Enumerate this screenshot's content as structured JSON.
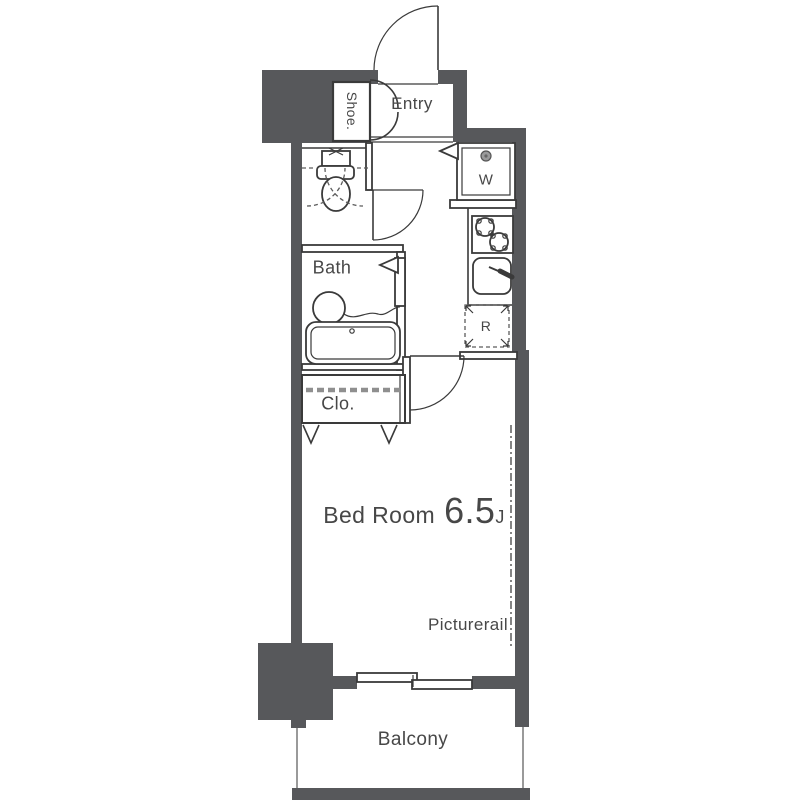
{
  "title": "Studio apartment floor plan",
  "colors": {
    "wall": "#57585b",
    "line": "#3a3a3a",
    "text": "#474747",
    "muted": "#9a9a9a",
    "closet_dash": "#8f8f8f"
  },
  "rooms": {
    "shoe": {
      "label": "Shoe."
    },
    "entry": {
      "label": "Entry"
    },
    "washer": {
      "label": "W"
    },
    "bath": {
      "label": "Bath"
    },
    "closet": {
      "label": "Clo."
    },
    "fridge": {
      "label": "R"
    },
    "bedroom": {
      "label": "Bed Room",
      "size": "6.5",
      "unit": "J"
    },
    "picture_rail": {
      "label": "Picturerail"
    },
    "balcony": {
      "label": "Balcony"
    }
  },
  "icons": [
    "front-door-arc",
    "shoe-closet-doors",
    "toilet-icon",
    "toilet-door-swing",
    "washing-machine-icon",
    "stove-icon",
    "kitchen-sink-icon",
    "fridge-space-box",
    "bath-door",
    "wash-basin-icon",
    "bathtub-icon",
    "closet-hanger-icon",
    "bedroom-door-arc",
    "sliding-window-icon",
    "picture-rail-line",
    "balcony-rail"
  ]
}
